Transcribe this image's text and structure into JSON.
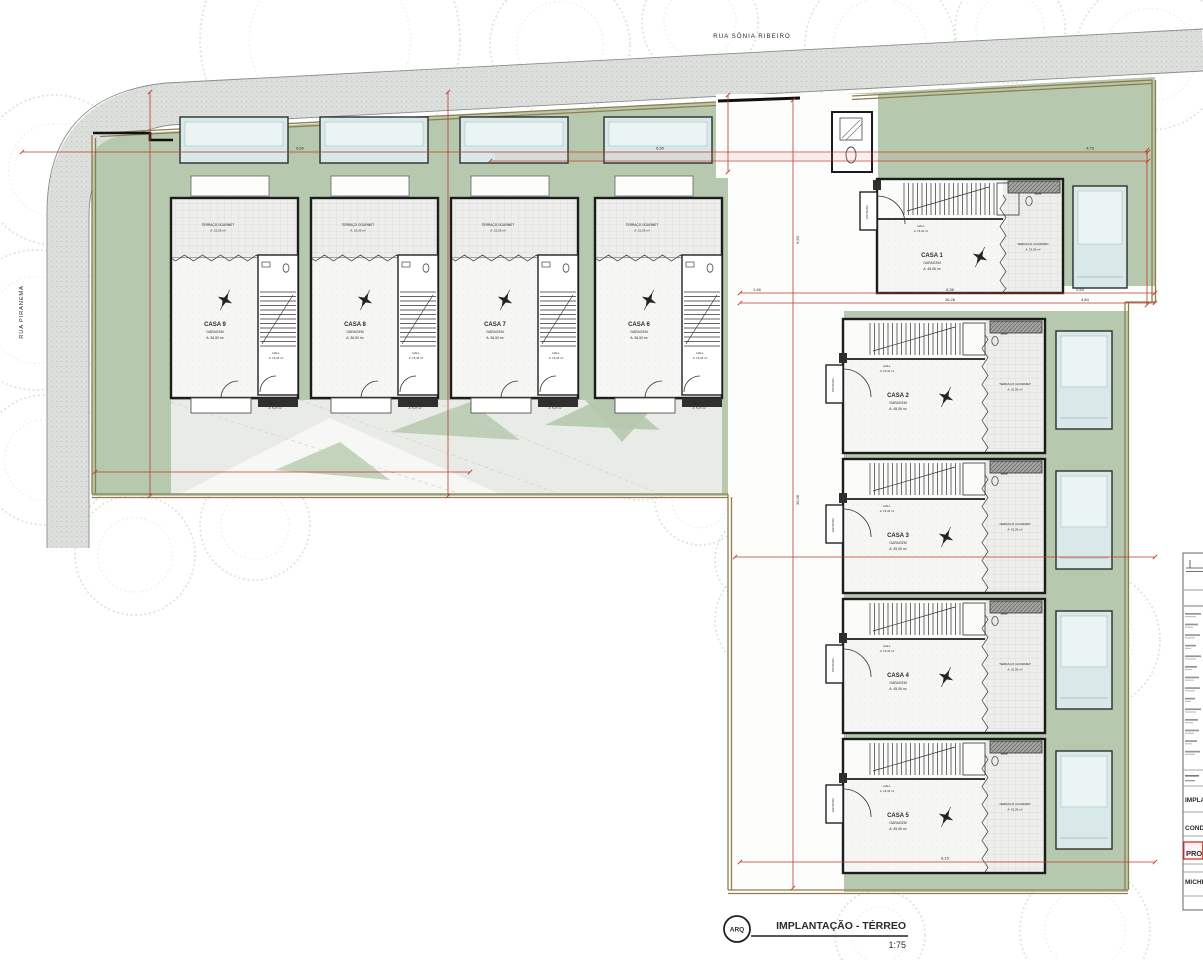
{
  "streets": {
    "top": "RUA SÔNIA RIBEIRO",
    "left": "RUA PIRANEMA"
  },
  "sheet": {
    "discipline": "ARQ",
    "title": "IMPLANTAÇÃO - TÉRREO",
    "scale": "1:75"
  },
  "room_labels": {
    "terraco": "TERRAÇO GOURMET",
    "terraco_area": "A: 32,09 m²",
    "hall": "HALL",
    "hall_area": "A: 15,34 m²",
    "entrada": "ENTRADA",
    "entrada_area": "A: 5,17 m²",
    "garagem": "GARAGEM"
  },
  "houses": [
    {
      "id": "casa-1",
      "name": "CASA 1",
      "area": "A: 45,06 m²"
    },
    {
      "id": "casa-2",
      "name": "CASA 2",
      "area": "A: 45,06 m²"
    },
    {
      "id": "casa-3",
      "name": "CASA 3",
      "area": "A: 45,06 m²"
    },
    {
      "id": "casa-4",
      "name": "CASA 4",
      "area": "A: 45,06 m²"
    },
    {
      "id": "casa-5",
      "name": "CASA 5",
      "area": "A: 45,06 m²"
    },
    {
      "id": "casa-6",
      "name": "CASA 6",
      "area": "A: 36,50 m²"
    },
    {
      "id": "casa-7",
      "name": "CASA 7",
      "area": "A: 36,50 m²"
    },
    {
      "id": "casa-8",
      "name": "CASA 8",
      "area": "A: 36,50 m²"
    },
    {
      "id": "casa-9",
      "name": "CASA 9",
      "area": "A: 36,50 m²"
    }
  ],
  "dim_labels": [
    "6,50",
    "6,50",
    "4,75",
    "1,46",
    "6,36",
    "2,54",
    "16,28",
    "4,84",
    "35,06",
    "6,50",
    "6,15"
  ],
  "title_block": {
    "fragments": [
      "IMPLA",
      "COND",
      "PRO",
      "MICHE"
    ]
  },
  "colors": {
    "green": "#b6c9ae",
    "street": "#dcdfdb",
    "boundary": "#8f7d4e",
    "dim": "#c0392b",
    "pool": "#d9e8e8",
    "pool_light": "#eaf4f3",
    "wall": "#1c1c1c",
    "tree": "#cfe0ca",
    "stamp": "#cc2222"
  }
}
